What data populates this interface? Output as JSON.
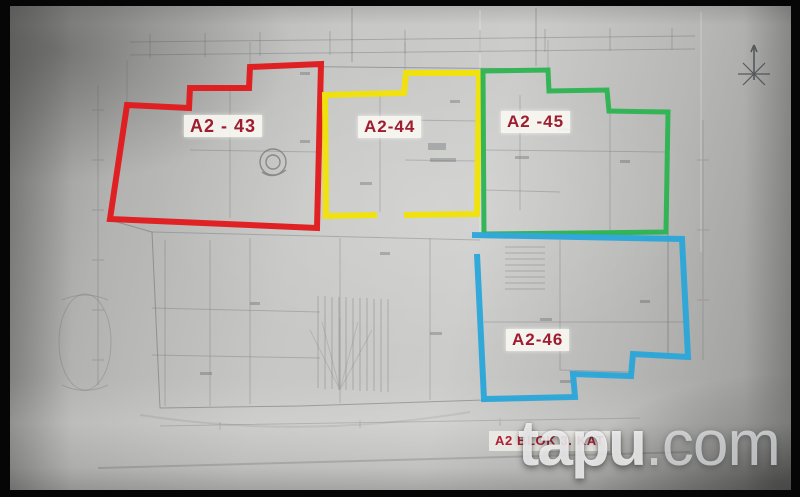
{
  "photo": {
    "description": "Photograph of an architectural floor plan blueprint with four apartment units outlined in color",
    "units": [
      {
        "label": "A2 - 43",
        "outline_color": "#e2191c"
      },
      {
        "label": "A2-44",
        "outline_color": "#f2e306"
      },
      {
        "label": "A2 -45",
        "outline_color": "#2cb451"
      },
      {
        "label": "A2-46",
        "outline_color": "#2aa7da"
      }
    ],
    "label_text_color": "#9e1c2e",
    "caption": {
      "text": "A2 BLOK 3. KAT",
      "color": "#b01f33"
    },
    "watermark": {
      "brand": "tapu",
      "tld": ".com"
    },
    "icons": {
      "north_arrow": "compass-star-icon"
    }
  }
}
